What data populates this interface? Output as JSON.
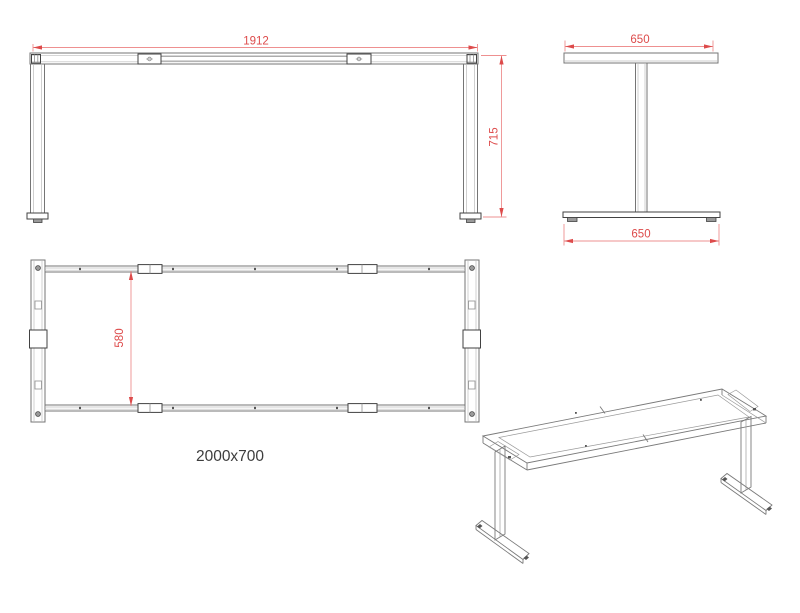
{
  "caption": "2000x700",
  "views": {
    "front": {
      "width_dim": "1912",
      "height_dim": "715"
    },
    "side": {
      "top_width_dim": "650",
      "bottom_width_dim": "650"
    },
    "plan": {
      "inner_depth_dim": "580"
    }
  },
  "colors": {
    "dimension_text": "#dd4b4b",
    "dimension_line": "#ee9090",
    "outline": "#757575",
    "detail_dark": "#424242",
    "background": "#ffffff"
  }
}
